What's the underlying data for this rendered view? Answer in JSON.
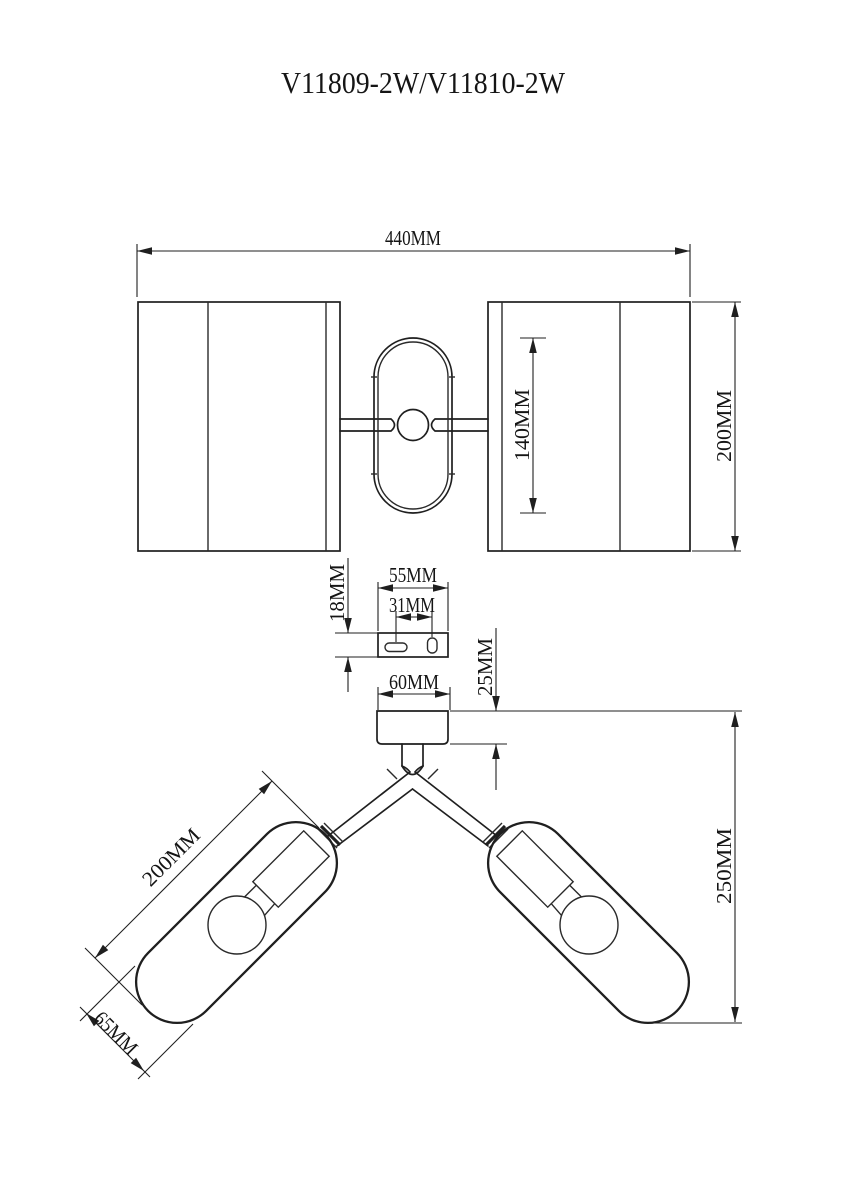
{
  "title": "V11809-2W/V11810-2W",
  "colors": {
    "ink": "#1f1f1f",
    "background": "#ffffff"
  },
  "front_view": {
    "overall_width_label": "440MM",
    "shade_height_label": "200MM",
    "center_body_height_label": "140MM"
  },
  "bracket_view": {
    "plate_width_label": "55MM",
    "hole_spacing_label": "31MM",
    "plate_height_label": "18MM"
  },
  "side_view": {
    "canopy_width_label": "60MM",
    "canopy_height_label": "25MM",
    "total_projection_label": "250MM",
    "shade_length_label": "200MM",
    "shade_diameter_label": "65MM"
  }
}
